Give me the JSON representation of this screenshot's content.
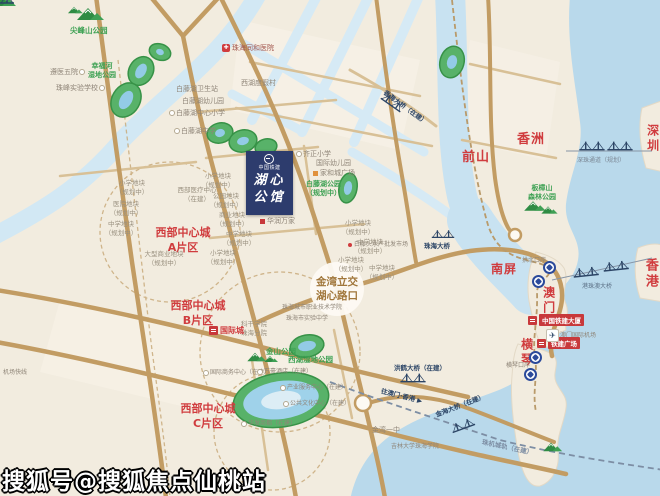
{
  "watermark": "搜狐号@搜狐焦点仙桃站",
  "project": {
    "developer": "中国铁建",
    "name_line1": "湖心",
    "name_line2": "公馆"
  },
  "districts": {
    "qianshan": "前山",
    "xiangzhou": "香洲",
    "shenzhen": "深圳",
    "nanping": "南屏",
    "aomen": "澳门",
    "hengqin": "横琴",
    "xianggang": "香港"
  },
  "zones": {
    "prefix": "西部中心城",
    "a": "A片区",
    "b": "B片区",
    "c": "C片区"
  },
  "junction": {
    "line1": "金湾立交",
    "line2": "湖心路口"
  },
  "parks": {
    "jianfengshan": "尖峰山公园",
    "xingfuhe_1": "幸福河",
    "xingfuhe_2": "湿地公园",
    "baitenghu_1": "白藤湖公园",
    "baitenghu_2": "（规划中）",
    "xihu": "西湖湿地公园",
    "jinshan": "金山公园",
    "banzhangshan_1": "板樟山",
    "banzhangshan_2": "森林公园"
  },
  "pois": {
    "zunyi": "遵医五院",
    "zhufeng": "珠峰实验学校",
    "baiteng_clinic": "白藤湖卫生站",
    "baiteng_kg": "白藤湖幼儿园",
    "baiteng_primary": "白藤湖中心小学",
    "baiteng_middle": "白藤湖中学",
    "xihu_resort": "西湖度假村",
    "tonghe_hospital": "珠海同和医院",
    "qizheng_primary": "齐正小学",
    "intl_kindergarten": "国际幼儿园",
    "jiahe_plaza": "家和城广场",
    "huarun": "华润万家",
    "west_medical_1": "西部医疗中心",
    "west_medical_2": "（在建）",
    "kegan_college": "科干学院珠海分院",
    "city_college": "珠海城市职业技术学院",
    "shiyan_middle": "珠海市实验中学",
    "intl_business": "国际商务中心（在建）",
    "wanhao_hotel": "万豪酒店（在建）",
    "industry_center": "产业服务中心（在建）",
    "culture_center": "公共文化中心（在建）",
    "huafa_mall": "华发商都（在建）",
    "jinwan_no1": "金湾一中",
    "jilin_univ": "吉林大学珠海学院",
    "baitengtou_market": "白藤头水产批发市场",
    "macau_airport": "澳门国际机场",
    "hengqin_port": "横琴口岸",
    "gongbei_port": "拱北口岸"
  },
  "parcels": {
    "school": "小学地块",
    "middle": "中学地块",
    "business": "商业地块",
    "park": "公园地块",
    "hospital": "医院地块",
    "large_business": "大型商业地块",
    "plan": "（规划中）"
  },
  "bridges": {
    "zhuhai": "珠海大桥",
    "shenzhu": "深珠通道（规划）",
    "hzmb": "港珠澳大桥",
    "honghe": "洪鹤大桥（在建）",
    "xianghai": "香海大桥（在建）",
    "jinhai": "金海大桥（在建）",
    "zhuji_rail": "珠机城轨（在建）",
    "to_macau_hk": "往澳门·香港"
  },
  "landmarks": {
    "crcc_tower": "中国铁建大厦",
    "crcc_plaza": "铁建广场",
    "intl_city": "国际城"
  },
  "road_signs": {
    "airport_express": "机场快线"
  },
  "icons": {
    "hospital": "✚",
    "airplane": "✈",
    "arrow": "▶"
  }
}
